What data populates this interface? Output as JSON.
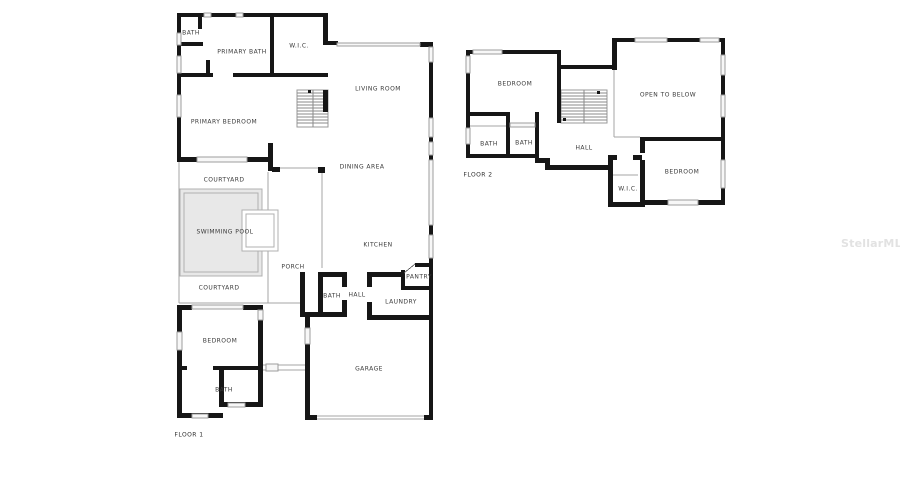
{
  "watermark": {
    "text": "StellarMLS"
  },
  "colors": {
    "wall": "#161616",
    "thin_line": "#a6a6a6",
    "window_fill": "#f7f7f7",
    "window_edge": "#9c9c9c",
    "pool_fill": "#e8e8e8",
    "pool_edge": "#b0b0b0",
    "label_text": "#3a3a3a",
    "watermark_text": "#e2e2e2",
    "background": "#ffffff"
  },
  "floor1": {
    "label": "FLOOR 1",
    "rooms": [
      {
        "name": "bath",
        "label": "BATH"
      },
      {
        "name": "primary-bath",
        "label": "PRIMARY BATH"
      },
      {
        "name": "wic",
        "label": "W.I.C."
      },
      {
        "name": "living-room",
        "label": "LIVING ROOM"
      },
      {
        "name": "primary-bedroom",
        "label": "PRIMARY BEDROOM"
      },
      {
        "name": "dining-area",
        "label": "DINING AREA"
      },
      {
        "name": "courtyard-top",
        "label": "COURTYARD"
      },
      {
        "name": "swimming-pool",
        "label": "SWIMMING POOL"
      },
      {
        "name": "kitchen",
        "label": "KITCHEN"
      },
      {
        "name": "porch",
        "label": "PORCH"
      },
      {
        "name": "pantry",
        "label": "PANTRY"
      },
      {
        "name": "courtyard-bottom",
        "label": "COURTYARD"
      },
      {
        "name": "bath-2",
        "label": "BATH"
      },
      {
        "name": "hall",
        "label": "HALL"
      },
      {
        "name": "laundry",
        "label": "LAUNDRY"
      },
      {
        "name": "bedroom",
        "label": "BEDROOM"
      },
      {
        "name": "garage",
        "label": "GARAGE"
      },
      {
        "name": "bath-3",
        "label": "BATH"
      }
    ]
  },
  "floor2": {
    "label": "FLOOR 2",
    "rooms": [
      {
        "name": "bedroom-1",
        "label": "BEDROOM"
      },
      {
        "name": "open-to-below",
        "label": "OPEN TO BELOW"
      },
      {
        "name": "bath-1",
        "label": "BATH"
      },
      {
        "name": "bath-2",
        "label": "BATH"
      },
      {
        "name": "hall",
        "label": "HALL"
      },
      {
        "name": "bedroom-2",
        "label": "BEDROOM"
      },
      {
        "name": "wic",
        "label": "W.I.C."
      }
    ]
  }
}
